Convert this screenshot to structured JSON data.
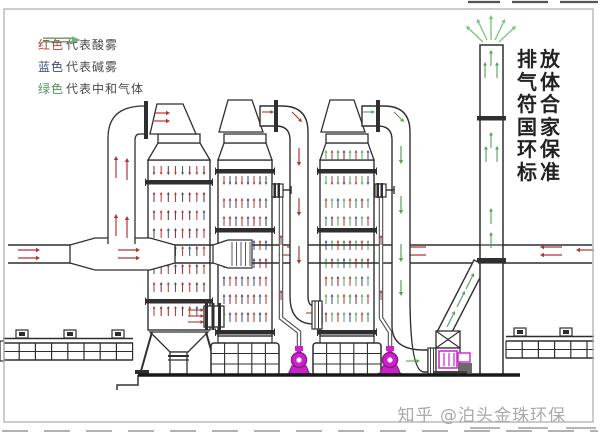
{
  "legend": {
    "items": [
      {
        "label": "红色",
        "label_color": "#a84438",
        "arrow_color": "#b5342e",
        "desc": "代表酸雾"
      },
      {
        "label": "蓝色",
        "label_color": "#3c4c78",
        "arrow_color": "#3a4460",
        "desc": "代表碱雾"
      },
      {
        "label": "绿色",
        "label_color": "#56925c",
        "arrow_color": "#6ab46e",
        "desc": "代表中和气体"
      }
    ]
  },
  "right_note": {
    "lines": [
      "排放",
      "气体",
      "符合",
      "国家",
      "环保",
      "标准"
    ],
    "full_text": "排放气体符合国家环保标准"
  },
  "watermark": {
    "text": "知乎 @泊头金珠环保"
  },
  "flow_colors": {
    "acid_mist": "#b5342e",
    "alkali_mist": "#3a4a8c",
    "neutral_gas": "#57a05a",
    "neutral_gas_light": "#7ac47a",
    "pump": "#cc22cc",
    "pump_dark": "#8a1a8a",
    "line": "#2f2f2f"
  }
}
